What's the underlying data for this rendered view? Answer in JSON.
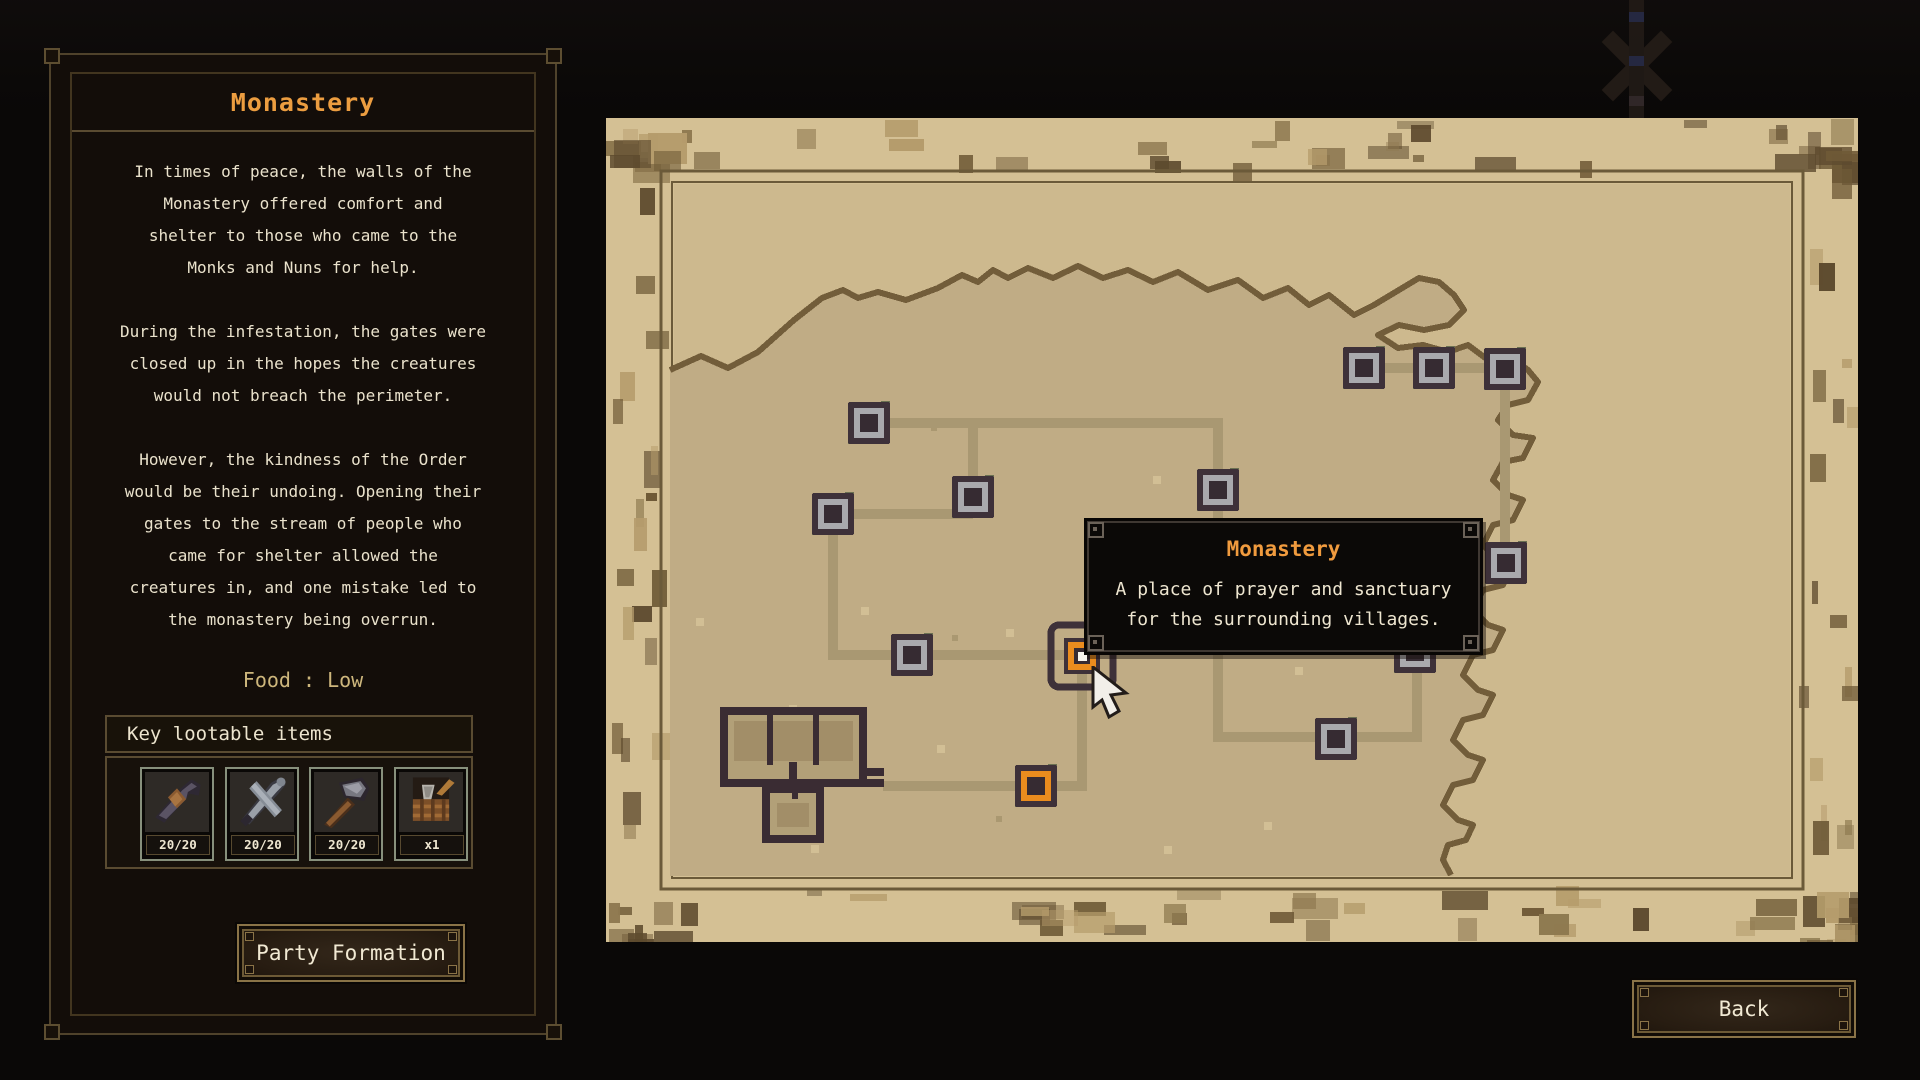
{
  "panel": {
    "title": "Monastery",
    "paragraphs": [
      [
        "In times of peace, the walls of the",
        "Monastery offered comfort and",
        "shelter to those who came to the",
        "Monks and Nuns for help."
      ],
      [
        "During the infestation, the gates were",
        "closed up in the hopes the creatures",
        "would not breach the perimeter."
      ],
      [
        "However, the kindness of the Order",
        "would be their undoing. Opening their",
        "gates to the stream of people who",
        "came for shelter allowed the",
        "creatures in, and one mistake led to",
        "the monastery being overrun."
      ]
    ],
    "food_label": "Food : Low",
    "lootable_header": "Key lootable items",
    "items": [
      {
        "icon": "dagger-icon",
        "count": "20/20"
      },
      {
        "icon": "sword-icon",
        "count": "20/20"
      },
      {
        "icon": "hammer-icon",
        "count": "20/20"
      },
      {
        "icon": "supplies-icon",
        "count": "x1"
      }
    ],
    "party_button": "Party Formation"
  },
  "map": {
    "tooltip": {
      "title": "Monastery",
      "body_lines": [
        "A place of prayer and sanctuary",
        "for the surrounding villages."
      ]
    },
    "nodes": [
      {
        "id": "n1",
        "x": 263,
        "y": 305,
        "state": "normal"
      },
      {
        "id": "n2",
        "x": 367,
        "y": 379,
        "state": "normal"
      },
      {
        "id": "n3",
        "x": 227,
        "y": 396,
        "state": "normal"
      },
      {
        "id": "n4",
        "x": 306,
        "y": 537,
        "state": "normal"
      },
      {
        "id": "n5",
        "x": 476,
        "y": 538,
        "state": "selected"
      },
      {
        "id": "n6",
        "x": 430,
        "y": 668,
        "state": "orange"
      },
      {
        "id": "n7",
        "x": 612,
        "y": 372,
        "state": "normal"
      },
      {
        "id": "n8",
        "x": 758,
        "y": 250,
        "state": "normal"
      },
      {
        "id": "n9",
        "x": 828,
        "y": 250,
        "state": "normal"
      },
      {
        "id": "n10",
        "x": 899,
        "y": 251,
        "state": "normal"
      },
      {
        "id": "n11",
        "x": 900,
        "y": 445,
        "state": "normal"
      },
      {
        "id": "n12",
        "x": 730,
        "y": 621,
        "state": "normal"
      },
      {
        "id": "n13",
        "x": 809,
        "y": 534,
        "state": "normal"
      }
    ],
    "roads": [
      [
        [
          263,
          305
        ],
        [
          367,
          305
        ],
        [
          367,
          379
        ]
      ],
      [
        [
          367,
          305
        ],
        [
          612,
          305
        ],
        [
          612,
          372
        ]
      ],
      [
        [
          227,
          396
        ],
        [
          367,
          396
        ]
      ],
      [
        [
          227,
          396
        ],
        [
          227,
          537
        ],
        [
          306,
          537
        ]
      ],
      [
        [
          306,
          537
        ],
        [
          476,
          537
        ]
      ],
      [
        [
          430,
          668
        ],
        [
          476,
          668
        ],
        [
          476,
          538
        ]
      ],
      [
        [
          277,
          668
        ],
        [
          430,
          668
        ]
      ],
      [
        [
          758,
          250
        ],
        [
          899,
          250
        ]
      ],
      [
        [
          899,
          251
        ],
        [
          899,
          445
        ]
      ],
      [
        [
          612,
          372
        ],
        [
          612,
          619
        ],
        [
          730,
          619
        ]
      ],
      [
        [
          730,
          619
        ],
        [
          811,
          619
        ],
        [
          811,
          534
        ]
      ]
    ],
    "building": {
      "x": 114,
      "y": 589
    },
    "colors": {
      "margin": "#d4c094",
      "sea": "#cdb98e",
      "land": "#c0ac85",
      "coast": "#725d3a",
      "road": "#a99872",
      "node_dark": "#3e3139",
      "node_gray": "#a9a9ad",
      "orange": "#ea8c1e",
      "accent": "#6b7152",
      "building_dark": "#3a2c33",
      "building_floor": "#b2a078",
      "building_panel": "#a28e68"
    }
  },
  "back_button": "Back"
}
